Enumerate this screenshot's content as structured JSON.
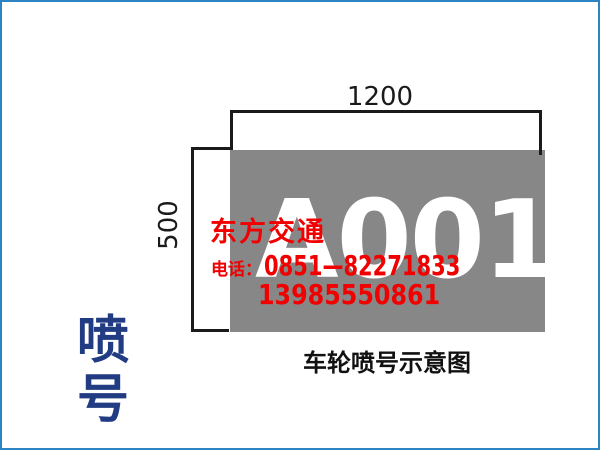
{
  "frame": {
    "border_color": "#2c85c2",
    "background": "#ffffff"
  },
  "sidebar": {
    "title": "喷号",
    "char_top": "喷",
    "char_bottom": "号",
    "color": "#223c84"
  },
  "diagram": {
    "plate_number": "A001",
    "plate_color": "#878787",
    "plate_number_color": "#ffffff",
    "width_label": "1200",
    "height_label": "500",
    "caption": "车轮喷号示意图"
  },
  "watermark": {
    "company": "东方交通",
    "phone_label": "电话：",
    "phone_number_1": "0851—82271833",
    "phone_number_2": "13985550861",
    "color": "#f10000"
  }
}
